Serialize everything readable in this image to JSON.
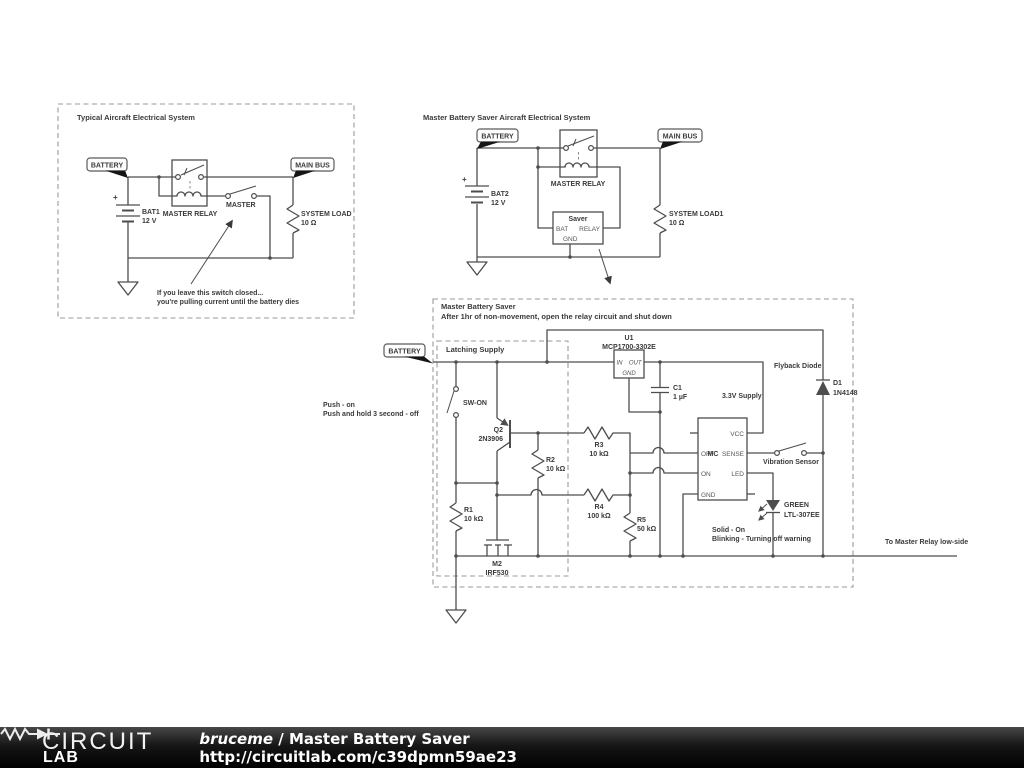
{
  "colors": {
    "wire": "#4d4d4d",
    "label_text": "#3a3a3a",
    "dashed_box": "#9a9a9a",
    "flag_tip": "#151515",
    "footer_bg": "#000000",
    "footer_text": "#ffffff"
  },
  "block1": {
    "title": "Typical Aircraft Electrical System",
    "battery_flag": "BATTERY",
    "main_bus_flag": "MAIN BUS",
    "bat_ref": "BAT1",
    "bat_val": "12 V",
    "bat_plus": "+",
    "relay_label": "MASTER RELAY",
    "switch_label": "MASTER",
    "load_ref": "SYSTEM LOAD",
    "load_val": "10 Ω",
    "note1": "If you leave this switch closed...",
    "note2": "you're pulling current until the battery dies"
  },
  "block2": {
    "title": "Master Battery Saver Aircraft Electrical System",
    "battery_flag": "BATTERY",
    "main_bus_flag": "MAIN BUS",
    "bat_ref": "BAT2",
    "bat_val": "12 V",
    "bat_plus": "+",
    "relay_label": "MASTER RELAY",
    "saver": {
      "title": "Saver",
      "pin_bat": "BAT",
      "pin_relay": "RELAY",
      "pin_gnd": "GND"
    },
    "load_ref": "SYSTEM LOAD1",
    "load_val": "10 Ω"
  },
  "block3": {
    "title": "Master Battery Saver",
    "subtitle": "After 1hr of non-movement, open the relay circuit and shut down",
    "latching_label": "Latching Supply",
    "battery_flag": "BATTERY",
    "push_note1": "Push - on",
    "push_note2": "Push and hold 3 second - off",
    "sw_on": "SW-ON",
    "q2_ref": "Q2",
    "q2_val": "2N3906",
    "r1_ref": "R1",
    "r1_val": "10 kΩ",
    "r2_ref": "R2",
    "r2_val": "10 kΩ",
    "r3_ref": "R3",
    "r3_val": "10 kΩ",
    "r4_ref": "R4",
    "r4_val": "100 kΩ",
    "r5_ref": "R5",
    "r5_val": "50 kΩ",
    "m2_ref": "M2",
    "m2_val": "IRF530",
    "u1_ref": "U1",
    "u1_val": "MCP1700-3302E",
    "u1_pins": {
      "in": "IN",
      "out": "OUT",
      "gnd": "GND"
    },
    "c1_ref": "C1",
    "c1_val": "1 µF",
    "supply_label": "3.3V Supply",
    "flyback_label": "Flyback Diode",
    "d1_ref": "D1",
    "d1_val": "1N4148",
    "mcu_label": "MC",
    "mcu_pins": {
      "vcc": "VCC",
      "sense": "SENSE",
      "led": "LED",
      "off": "OFF",
      "on": "ON",
      "gnd": "GND"
    },
    "vibration_label": "Vibration Sensor",
    "led_color": "GREEN",
    "led_part": "LTL-307EE",
    "led_note1": "Solid - On",
    "led_note2": "Blinking - Turning off warning",
    "relay_note": "To Master Relay low-side"
  },
  "footer": {
    "logo_word": "CIRCUIT",
    "logo_lab": "LAB",
    "author": "bruceme",
    "separator": " / ",
    "project": "Master Battery Saver",
    "url": "http://circuitlab.com/c39dpmn59ae23"
  }
}
